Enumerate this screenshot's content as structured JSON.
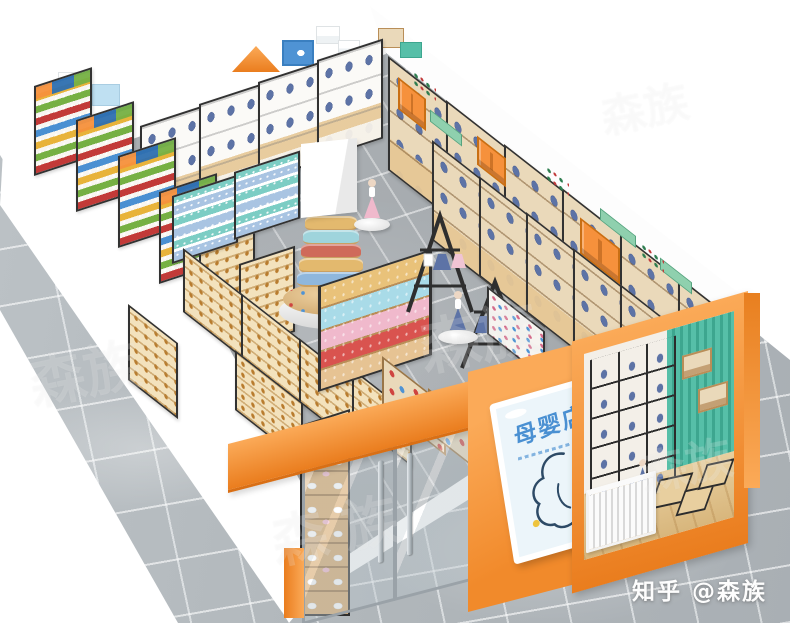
{
  "sign": {
    "title": "母婴店"
  },
  "watermark": {
    "credit": "知乎 @森族",
    "ghost_text": "森族"
  },
  "colors": {
    "orange": "#f6913c",
    "orange_light": "#fbaa58",
    "orange_deep": "#ea7d1e",
    "orange_dark": "#d96f15",
    "teal": "#56bfa8",
    "teal_dark": "#3da68f",
    "green": "#8fd0ae",
    "wood": "#ead9ba",
    "wood_mid": "#d7ab72",
    "wood_dark": "#b98e58",
    "wall": "#ffffff",
    "wall_shade": "#ececec",
    "floor": "#a8adb1",
    "walkway": "#b4babe",
    "metal": "#2e2e2e",
    "steel": "#9aa2a8",
    "denim": "#5d73a6",
    "denim_dark": "#4a5f93",
    "glass": "#c7d1d6",
    "red": "#cf4440",
    "yellow": "#ecba3f",
    "blue": "#4f93d4",
    "sky": "#bfe0f2",
    "pink": "#f0b9cc",
    "gold": "#e3b96e",
    "sign_bg": "#ecf5fa",
    "sign_blue": "#4a90d2",
    "ink": "#2d4a66",
    "crib": "#f7f7f7"
  }
}
